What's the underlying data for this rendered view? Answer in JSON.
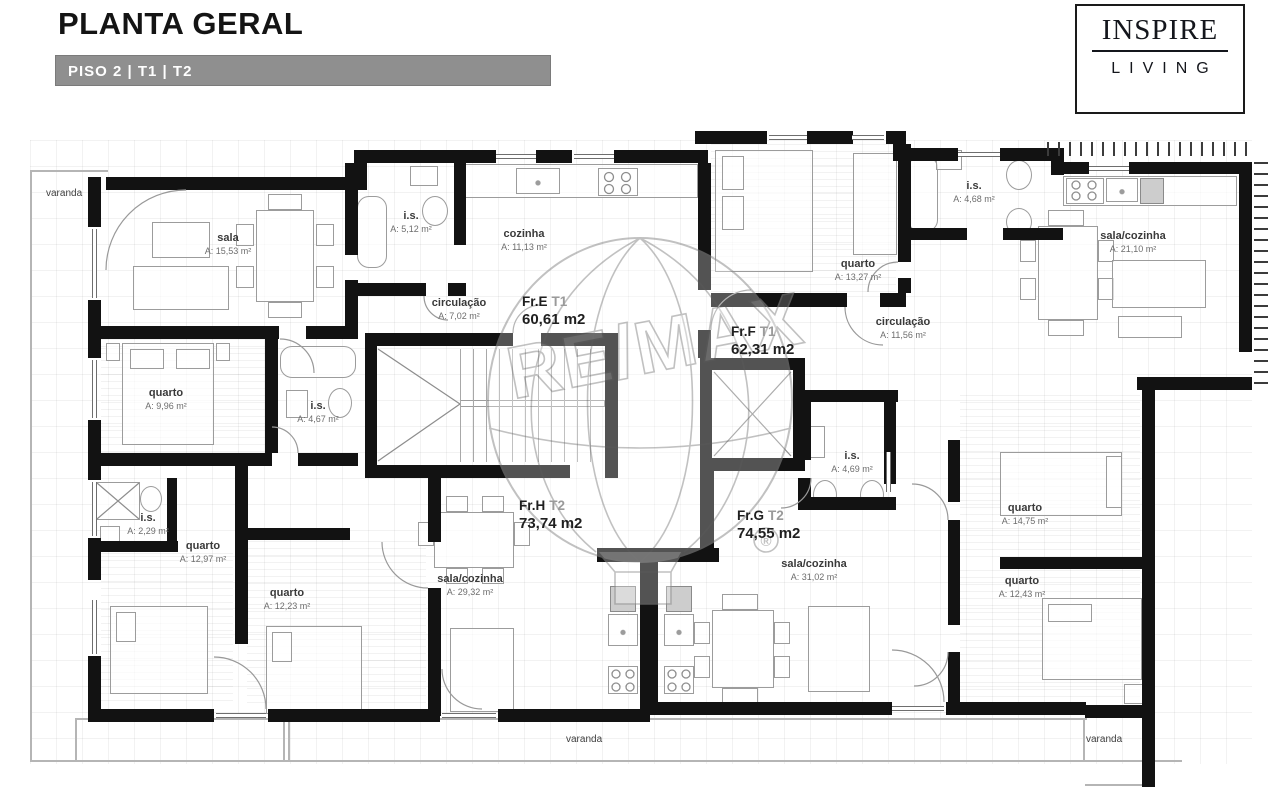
{
  "header": {
    "title": "PLANTA GERAL",
    "subtitle": "PISO 2 | T1 | T2"
  },
  "logo": {
    "line1": "INSPIRE",
    "line2": "LIVING"
  },
  "watermark": {
    "brand": "RE/MAX",
    "registered": "®"
  },
  "colors": {
    "wall": "#121212",
    "subtitle_bar": "#8f8f8f",
    "text": "#1f1f1f",
    "muted": "#6d6d6d"
  },
  "units": [
    {
      "id": "Fr.E",
      "type": "T1",
      "area": "60,61 m2"
    },
    {
      "id": "Fr.F",
      "type": "T1",
      "area": "62,31 m2"
    },
    {
      "id": "Fr.H",
      "type": "T2",
      "area": "73,74 m2"
    },
    {
      "id": "Fr.G",
      "type": "T2",
      "area": "74,55 m2"
    }
  ],
  "rooms": [
    {
      "name": "sala",
      "area": "A: 15,53 m²"
    },
    {
      "name": "i.s.",
      "area": "A: 5,12 m²"
    },
    {
      "name": "cozinha",
      "area": "A: 11,13 m²"
    },
    {
      "name": "circulação",
      "area": "A: 7,02 m²"
    },
    {
      "name": "quarto",
      "area": "A: 13,27 m²"
    },
    {
      "name": "i.s.",
      "area": "A: 4,68 m²"
    },
    {
      "name": "sala/cozinha",
      "area": "A: 21,10 m²"
    },
    {
      "name": "circulação",
      "area": "A: 11,56 m²"
    },
    {
      "name": "quarto",
      "area": "A: 9,96 m²"
    },
    {
      "name": "i.s.",
      "area": "A: 4,67 m²"
    },
    {
      "name": "i.s.",
      "area": "A: 4,69 m²"
    },
    {
      "name": "i.s.",
      "area": "A: 2,29 m²"
    },
    {
      "name": "quarto",
      "area": "A: 12,97 m²"
    },
    {
      "name": "quarto",
      "area": "A: 12,23 m²"
    },
    {
      "name": "sala/cozinha",
      "area": "A: 29,32 m²"
    },
    {
      "name": "sala/cozinha",
      "area": "A: 31,02 m²"
    },
    {
      "name": "quarto",
      "area": "A: 14,75 m²"
    },
    {
      "name": "quarto",
      "area": "A: 12,43 m²"
    }
  ],
  "balconies": [
    "varanda",
    "varanda",
    "varanda"
  ]
}
